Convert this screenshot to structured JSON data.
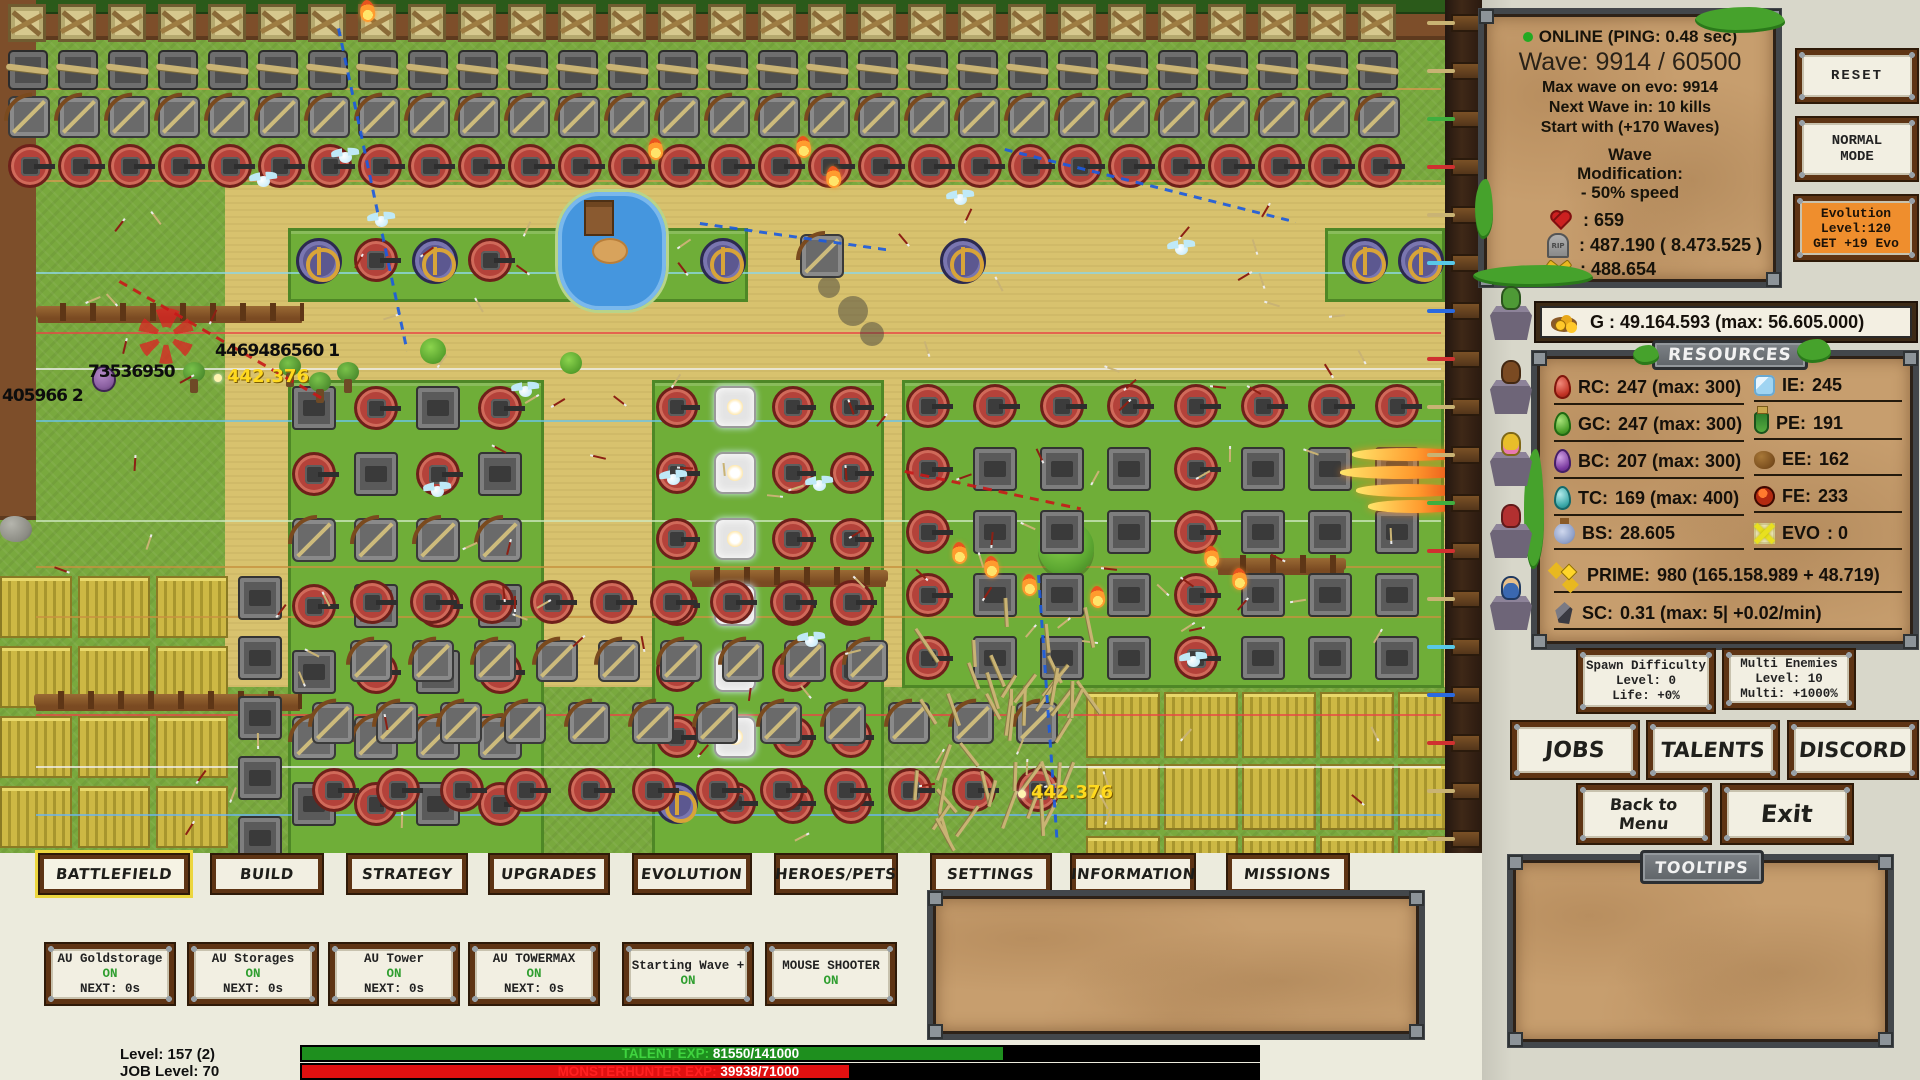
{
  "hud": {
    "status": {
      "online": "ONLINE (PING: 0.48 sec)",
      "wave": "Wave: 9914 / 60500",
      "max_wave": "Max wave on evo: 9914",
      "next_wave": "Next Wave in: 10 kills",
      "start_with": "Start with (+170 Waves)",
      "mod_line1": "Wave",
      "mod_line2": "Modification:",
      "mod_line3": "- 50% speed",
      "lives": ": 659",
      "deaths": ": 487.190 ( 8.473.525 )",
      "gold_tools": ": 488.654",
      "grave_text": "RIP"
    },
    "buttons": {
      "reset": "RESET",
      "normal1": "NORMAL",
      "normal2": "MODE",
      "evo1": "Evolution",
      "evo2": "Level:120",
      "evo3": "GET +19 Evo",
      "jobs": "JOBS",
      "talents": "TALENTS",
      "discord": "DISCORD",
      "back1": "Back to",
      "back2": "Menu",
      "exit": "Exit"
    },
    "spawn": {
      "l1": "Spawn Difficulty",
      "l2": "Level: 0",
      "l3": "Life: +0%"
    },
    "multi": {
      "l1": "Multi Enemies",
      "l2": "Level: 10",
      "l3": "Multi: +1000%"
    },
    "gold_bar": "G : 49.164.593 (max: 56.605.000)",
    "resources_title": "RESOURCES",
    "tooltips_title": "TOOLTIPS",
    "resources": {
      "left": [
        {
          "label": "RC:",
          "value": "247 (max: 300)"
        },
        {
          "label": "GC:",
          "value": "247 (max: 300)"
        },
        {
          "label": "BC:",
          "value": "207 (max: 300)"
        },
        {
          "label": "TC:",
          "value": "169 (max: 400)"
        },
        {
          "label": "BS:",
          "value": "28.605"
        }
      ],
      "right": [
        {
          "label": "IE:",
          "value": "245"
        },
        {
          "label": "PE:",
          "value": "191"
        },
        {
          "label": "EE:",
          "value": "162"
        },
        {
          "label": "FE:",
          "value": "233"
        },
        {
          "label": "EVO",
          "value": ": 0"
        }
      ],
      "prime_label": "PRIME:",
      "prime_value": "980 (165.158.989 + 48.719)",
      "sc_label": "SC:",
      "sc_value": "0.31 (max: 5| +0.02/min)"
    }
  },
  "tabs": [
    {
      "label": "BATTLEFIELD"
    },
    {
      "label": "BUILD"
    },
    {
      "label": "STRATEGY"
    },
    {
      "label": "UPGRADES"
    },
    {
      "label": "EVOLUTION"
    },
    {
      "label": "HEROES/PETS"
    },
    {
      "label": "SETTINGS"
    },
    {
      "label": "INFORMATION"
    },
    {
      "label": "MISSIONS"
    }
  ],
  "toggles": [
    {
      "name": "AU Goldstorage",
      "state": "ON",
      "next": "NEXT: 0s"
    },
    {
      "name": "AU Storages",
      "state": "ON",
      "next": "NEXT: 0s"
    },
    {
      "name": "AU Tower",
      "state": "ON",
      "next": "NEXT: 0s"
    },
    {
      "name": "AU TOWERMAX",
      "state": "ON",
      "next": "NEXT: 0s"
    },
    {
      "name": "Starting Wave +",
      "state": "ON",
      "next": ""
    },
    {
      "name": "MOUSE SHOOTER",
      "state": "ON",
      "next": ""
    }
  ],
  "exp": {
    "level": "Level: 157 (2)",
    "job_level": "JOB Level: 70",
    "talent_label": "TALENT EXP:",
    "talent_value": "81550/141000",
    "mh_label": "MONSTERHUNTER EXP:",
    "mh_value": "39938/71000"
  },
  "battlefield": {
    "numbers": [
      {
        "text": "4469486560 1"
      },
      {
        "text": "73536950"
      },
      {
        "text": "405966 2"
      }
    ],
    "crits": [
      {
        "text": "442.376"
      },
      {
        "text": "442.376"
      }
    ]
  },
  "colors": {
    "accent_orange": "#ef8e2d",
    "on_green": "#2f9e2f",
    "talent_green": "#3faf3f",
    "mh_red": "#e01010",
    "selected_tab_outline": "#ecd63e"
  }
}
